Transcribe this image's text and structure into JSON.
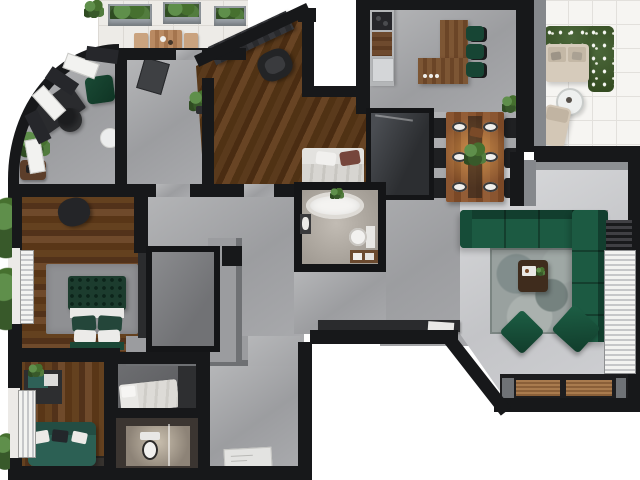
{
  "meta": {
    "title": "3D apartment floor plan – photorealistic top-down render",
    "type": "floor-plan",
    "view": "top-down",
    "visible_text": "none"
  },
  "palette": {
    "wall": "#17181a",
    "concrete_floor": "#a7a8ab",
    "living_floor": "#cfd0d3",
    "wood_floor": "#5f3c22",
    "emerald_sofa": "#1a5140",
    "teal_sofa": "#2e5f55",
    "plant_green": "#46702f",
    "terrace_tile": "#edebe7",
    "balcony_tile": "#f6f5f2",
    "outdoor_beige": "#d6cbbb"
  },
  "rooms": [
    {
      "id": "terrace",
      "name": "Terrace",
      "furniture": [
        "three planter boxes",
        "wooden outdoor dining table",
        "two benches"
      ]
    },
    {
      "id": "office",
      "name": "Curved-wall home office",
      "furniture": [
        "curved window band",
        "dark desk",
        "office chair",
        "green pouf",
        "potted plant",
        "white side table",
        "wooden side table"
      ]
    },
    {
      "id": "foyer",
      "name": "Foyer",
      "furniture": [
        "open door leaf",
        "floor plant"
      ]
    },
    {
      "id": "bedroom-1",
      "name": "Bedroom 1 (angled walls)",
      "furniture": [
        "wardrobe",
        "dark armchair",
        "double bed with maroon and white pillows"
      ]
    },
    {
      "id": "kitchen",
      "name": "Kitchen",
      "furniture": [
        "wall counter with cooktop",
        "fridge",
        "L-shaped wooden island",
        "three green bar stools",
        "floor plant"
      ]
    },
    {
      "id": "dining",
      "name": "Dining area",
      "furniture": [
        "wooden table with warm light",
        "six black chairs",
        "six place settings",
        "green centerpiece"
      ]
    },
    {
      "id": "balcony",
      "name": "Balcony",
      "furniture": [
        "beige outdoor sofa",
        "round white side table",
        "beige lounge chair",
        "flowering hedge"
      ]
    },
    {
      "id": "living-room",
      "name": "Living room",
      "furniture": [
        "emerald L-shaped sectional sofa",
        "mottled gray rug",
        "dark wood coffee table",
        "two green poufs",
        "media console with wood slats",
        "horizontal window blinds"
      ]
    },
    {
      "id": "bathroom-1",
      "name": "Main bathroom",
      "furniture": [
        "freestanding oval bathtub",
        "toilet",
        "washbasin",
        "wooden shelf with towels"
      ]
    },
    {
      "id": "master-bedroom",
      "name": "Master bedroom",
      "furniture": [
        "green tufted bed",
        "white pillows",
        "gray rug",
        "dark armchair",
        "window blinds"
      ]
    },
    {
      "id": "walk-in-closet",
      "name": "Walk-in closet",
      "furniture": [
        "gray wardrobe slabs"
      ]
    },
    {
      "id": "storage-closet",
      "name": "Storage closet",
      "furniture": []
    },
    {
      "id": "bedroom-2",
      "name": "Bedroom 2",
      "furniture": [
        "teal sofa with pillows",
        "wall desk unit",
        "plant",
        "dark rug",
        "vertical window blinds"
      ]
    },
    {
      "id": "guest-nook",
      "name": "Guest nook",
      "furniture": [
        "white single bed"
      ]
    },
    {
      "id": "bathroom-2",
      "name": "Second bathroom",
      "furniture": [
        "toilet",
        "shower corner"
      ]
    },
    {
      "id": "hallway",
      "name": "Hallway / entry",
      "furniture": [
        "dark console with paper sheet",
        "white doormat"
      ]
    }
  ]
}
